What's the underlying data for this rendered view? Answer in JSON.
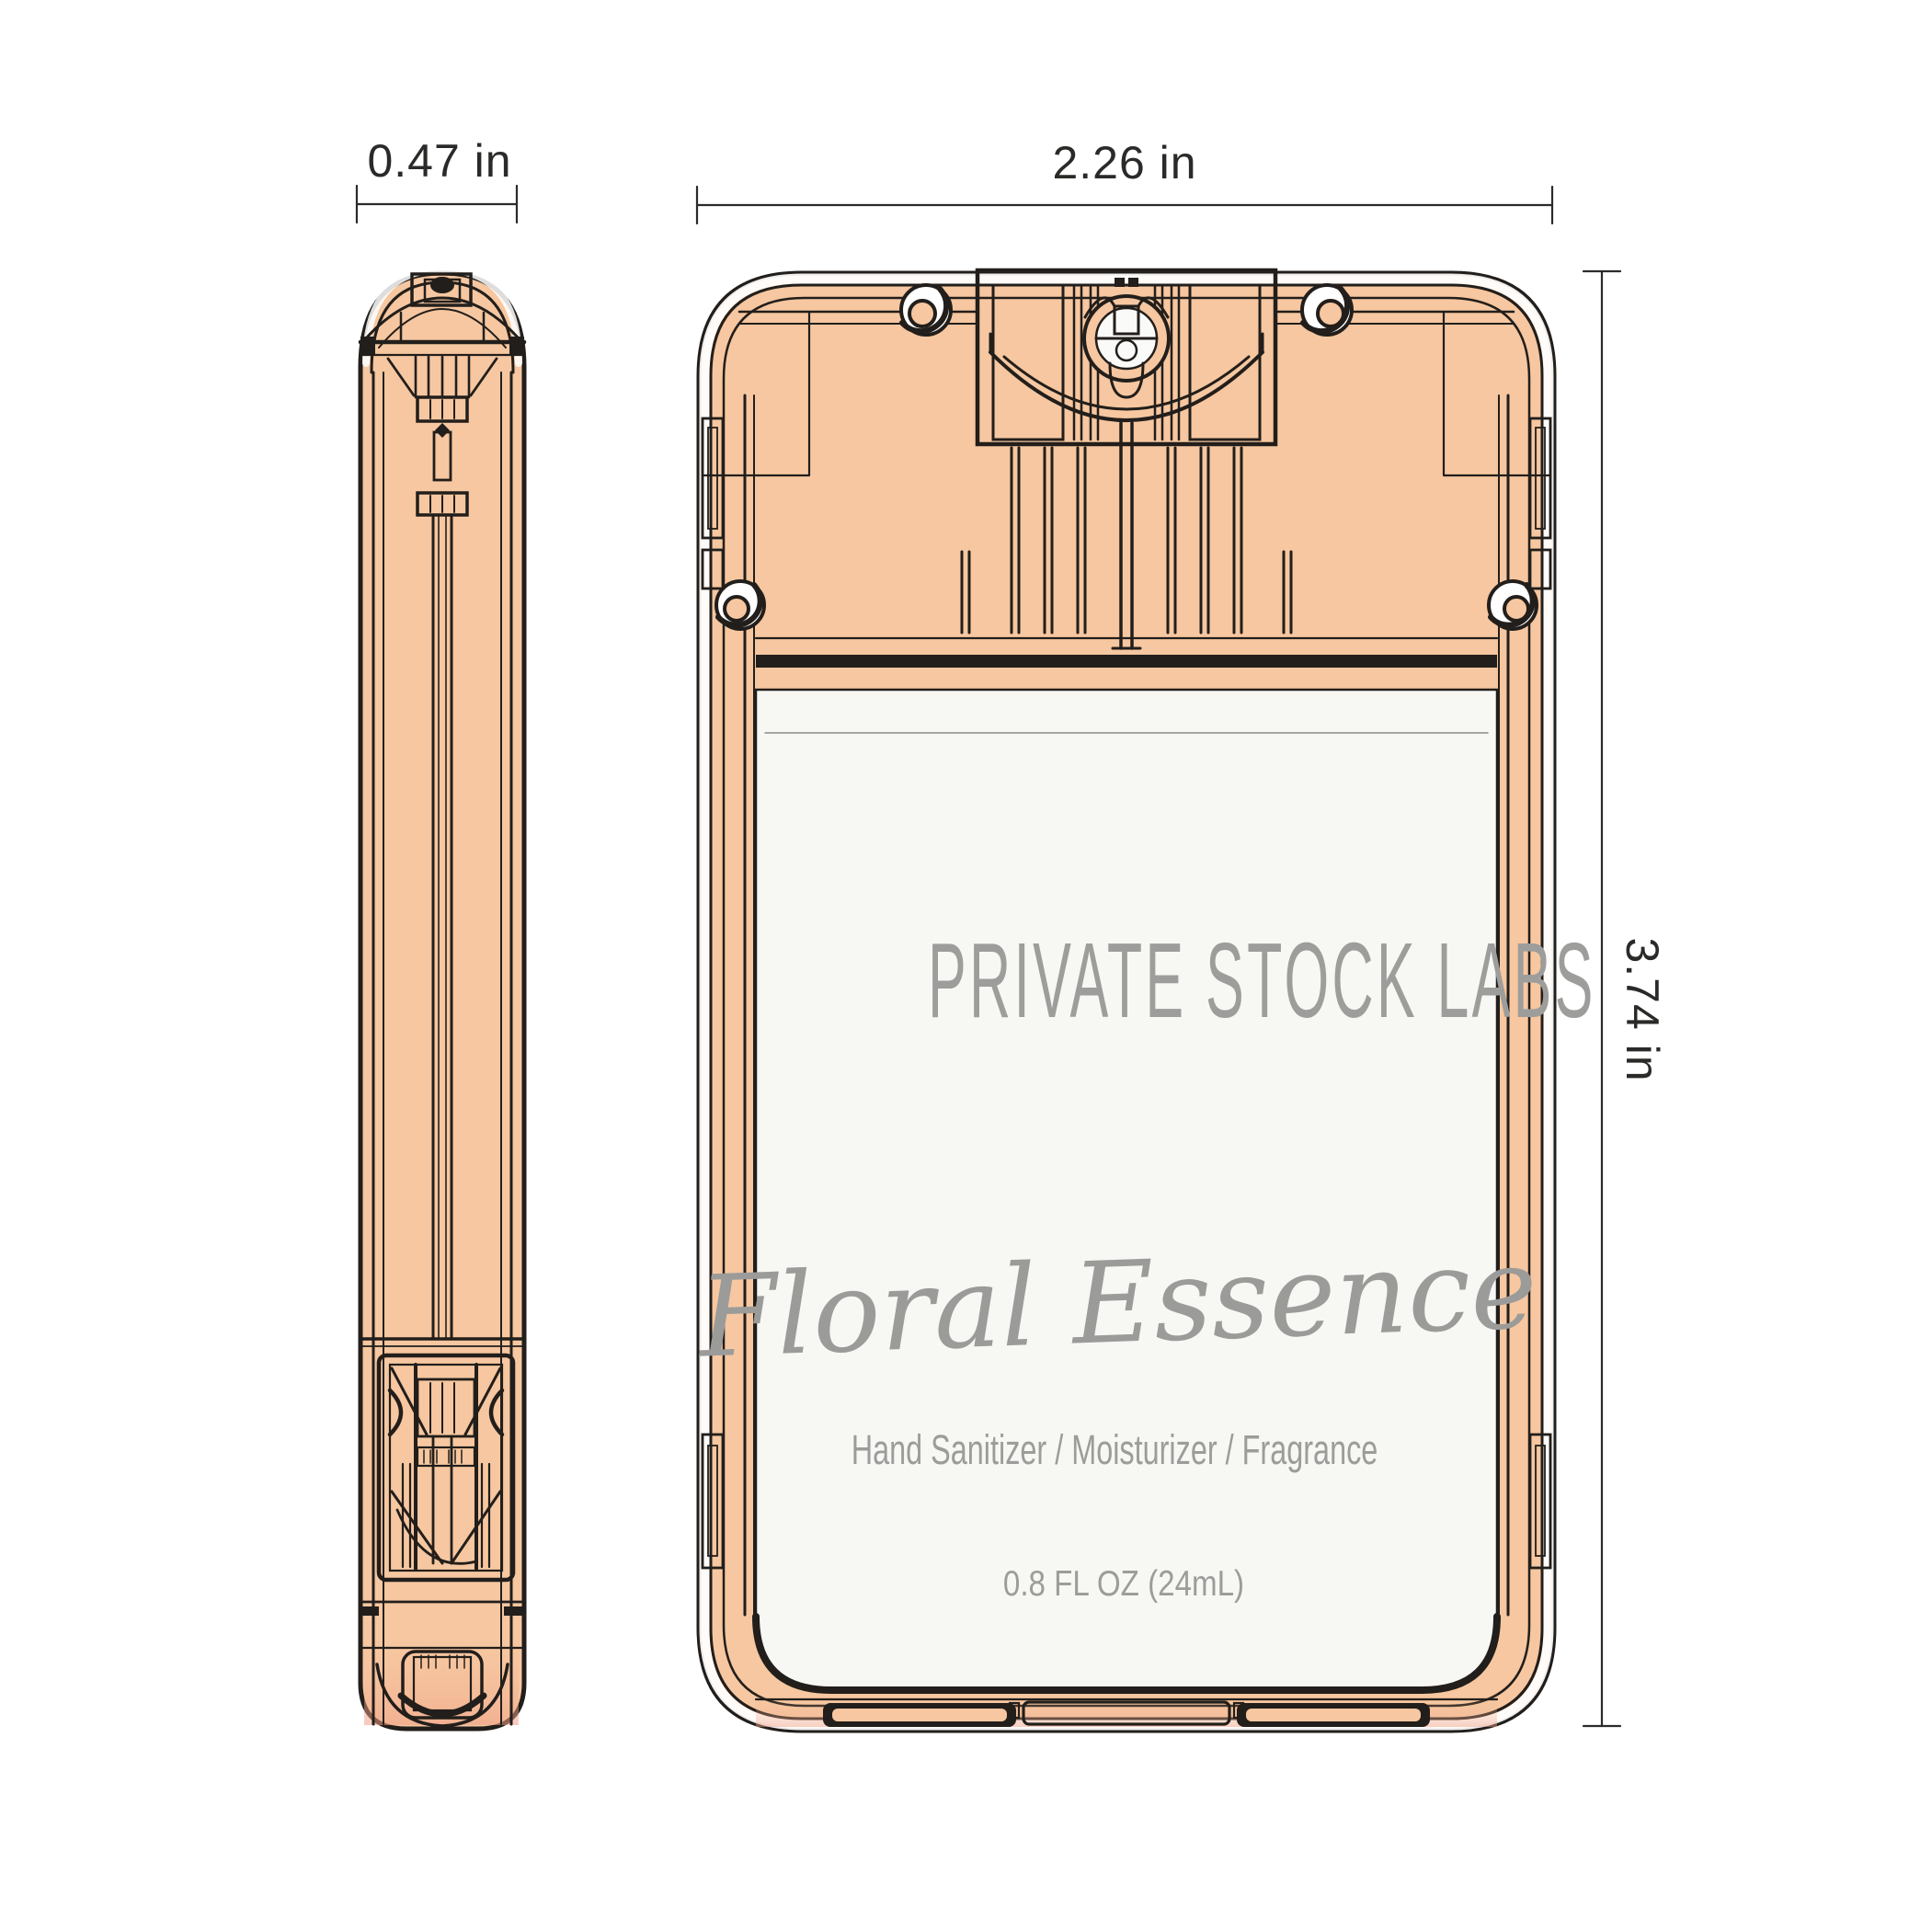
{
  "page": {
    "description": "Technical dimension drawing of a pocket spray hand sanitizer card, side profile view and front view",
    "background": "#FFFFFF"
  },
  "colors": {
    "body_peach": "#F6C7A0",
    "salmon_shade": "#EF9E86",
    "outline_black": "#221E1B",
    "dimension_line": "#2B2B29",
    "label_background": "#F7F7F4",
    "label_text_gray": "#9C9C9A"
  },
  "views": {
    "side_view": "side profile technical view",
    "front_view": "front technical view"
  },
  "dimensions": {
    "side_width": "0.47 in",
    "front_width": "2.26 in",
    "front_height": "3.74 in"
  },
  "label": {
    "brand": "PRIVATE STOCK LABS",
    "scent_script": "Floral Essence",
    "product_types": "Hand Sanitizer / Moisturizer / Fragrance",
    "volume": "0.8 FL OZ (24mL)"
  }
}
